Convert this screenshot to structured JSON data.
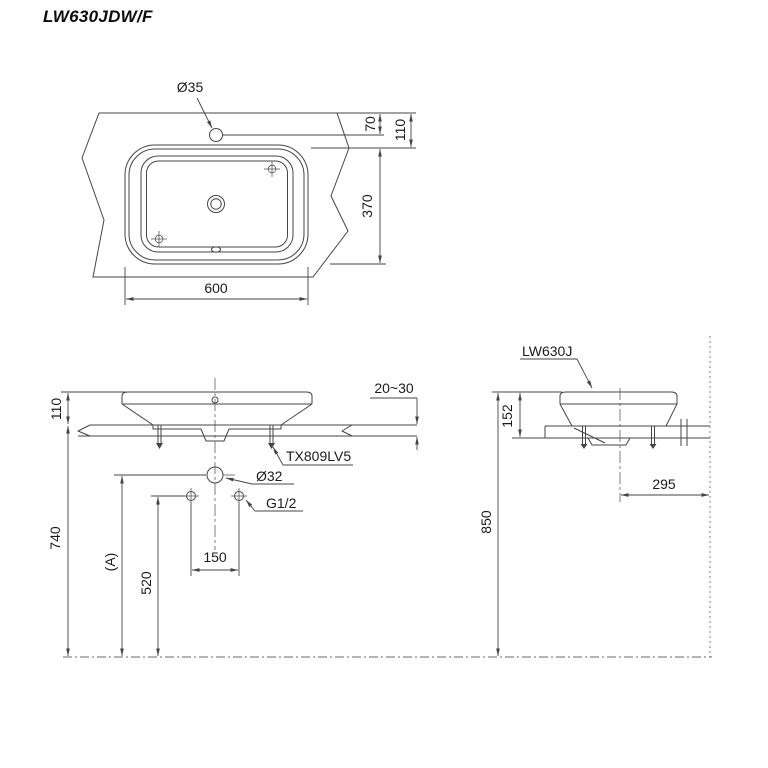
{
  "title": "LW630JDW/F",
  "top_view": {
    "faucet_hole_dia": "Ø35",
    "dim_faucet_offset": "70",
    "dim_basin_setback": "110",
    "dim_basin_depth": "370",
    "dim_basin_width": "600"
  },
  "front_view": {
    "dim_rim_above_counter": "110",
    "dim_counter_height": "740",
    "dim_a": "(A)",
    "dim_supply_height": "520",
    "dim_supply_spacing": "150",
    "dim_counter_thickness": "20~30",
    "fitting_label": "TX809LV5",
    "drain_dia": "Ø32",
    "supply_thread": "G1/2"
  },
  "side_view": {
    "model_label": "LW630J",
    "dim_rim_drop": "152",
    "dim_drain_wall_offset": "295",
    "dim_rim_floor_height": "850"
  }
}
